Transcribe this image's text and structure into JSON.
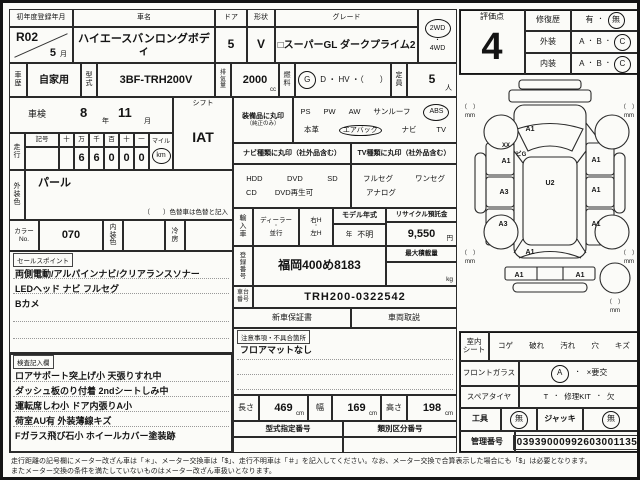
{
  "colors": {
    "paper": "#fbfbf8",
    "ink": "#141414"
  },
  "title_row": {
    "reg_label": "初年度登録年月",
    "reg_value": "R02",
    "reg_month": "5",
    "reg_month_unit": "月",
    "name_label": "車名",
    "name_value": "ハイエースバンロングボディ",
    "door_label": "ドア",
    "door_value": "5",
    "shape_label": "形状",
    "shape_value": "V",
    "grade_label": "グレード",
    "grade_value": "□スーパーGL ダークプライム2",
    "drive_2wd": "2WD",
    "drive_sep": "・",
    "drive_4wd": "4WD"
  },
  "spec_row": {
    "history_label": "車歴",
    "history_value": "自家用",
    "model_code_label": "型式",
    "model_code_value": "3BF-TRH200V",
    "displacement_label": "排気量",
    "displacement_value": "2000",
    "displacement_unit": "cc",
    "fuel_label": "燃料",
    "fuel_selected": "G",
    "fuel_options": "D ・ HV ・（　　）",
    "capacity_label": "定員",
    "capacity_value": "5",
    "capacity_unit": "人"
  },
  "left_panel": {
    "shaken_label": "車検",
    "shaken_year": "8",
    "year_unit": "年",
    "shaken_month": "11",
    "month_unit": "月",
    "shift_label": "シフト",
    "shift_value": "IAT",
    "run_label": "走行",
    "symbol_label": "記号",
    "digit_headers": [
      "十",
      "万",
      "千",
      "百",
      "十",
      "一"
    ],
    "digits": [
      "",
      "6",
      "6",
      "0",
      "0",
      "0"
    ],
    "mile_label": "マイル",
    "km_label": "km",
    "ext_color_label": "外装色",
    "ext_color_value": "パール",
    "color_note": "（　　）色替車は色替と記入",
    "color_no_label": "カラーNo.",
    "color_no_value": "070",
    "int_color_label": "内装色",
    "ac_label": "冷房",
    "sales_tab": "セールスポイント",
    "sales_lines": [
      "両側電動/アルパインナビ/クリアランスソナー",
      "LEDヘッド ナビ フルセグ",
      "Bカメ"
    ],
    "inspect_tab": "検査記入欄",
    "inspect_lines": [
      "ロアサポート突上げ小 天張りすれ中",
      "ダッシュ板のり付着 2ndシートしみ中",
      "運転席しわ小 ドア内張りA小",
      "荷室AU有 外装薄線キズ",
      "Fガラス飛び石小 ホイールカバー塗装跡"
    ]
  },
  "mid_panel": {
    "equip_label": "装備品に丸印",
    "equip_note": "（純正のみ）",
    "equip_row1": [
      "PS",
      "PW",
      "AW",
      "サンルーフ",
      "ABS"
    ],
    "equip_row2": [
      "本革",
      "エアバック",
      "ナビ",
      "TV"
    ],
    "navi_header": "ナビ種類に丸印（社外品含む）",
    "tv_header": "TV種類に丸印（社外品含む）",
    "navi_row1": [
      "HDD",
      "DVD",
      "SD"
    ],
    "navi_row2": [
      "CD",
      "DVD再生可"
    ],
    "tv_row1": [
      "フルセグ",
      "ワンセグ"
    ],
    "tv_row2": [
      "アナログ"
    ],
    "import_label": "輸入車",
    "dealer_option": "ディーラー",
    "parallel_option": "並行",
    "sep": "・",
    "right_h": "右H",
    "left_h": "左H",
    "model_year_label": "モデル年式",
    "model_year_unit": "年",
    "model_year_value": "不明",
    "recycle_label": "リサイクル預託金",
    "recycle_value": "9,550",
    "recycle_unit": "円",
    "plate_label": "登録番号",
    "plate_value": "福岡400め8183",
    "payload_label": "最大積載量",
    "payload_unit": "kg",
    "vin_label": "車台番号",
    "vin_value": "TRH200-0322542",
    "warranty_label": "新車保証書",
    "manual_label": "車両取説",
    "notes_tab": "注意事項・不具合箇所",
    "notes_value": "フロアマットなし",
    "length_label": "長さ",
    "length_value": "469",
    "width_label": "幅",
    "width_value": "169",
    "height_label": "高さ",
    "height_value": "198",
    "cm_unit": "cm",
    "type_cert_label": "型式指定番号",
    "class_no_label": "類別区分番号"
  },
  "right_panel": {
    "eval_label": "評価点",
    "eval_value": "4",
    "repair_label": "修復歴",
    "repair_yes": "有",
    "sep": "・",
    "repair_no": "無",
    "exterior_label": "外装",
    "interior_label": "内装",
    "grade_a": "A",
    "grade_b": "B",
    "grade_c": "C",
    "seat_label_1": "室内",
    "seat_label_2": "シート",
    "seat_items": [
      "コゲ",
      "破れ",
      "汚れ",
      "穴",
      "キズ"
    ],
    "glass_label": "フロントガラス",
    "glass_ok": "A",
    "glass_ng": "×要交",
    "spare_label": "スペアタイヤ",
    "spare_t": "T",
    "spare_kit": "修理KIT",
    "spare_missing": "欠",
    "tools_label": "工具",
    "tools_value": "無",
    "jack_label": "ジャッキ",
    "jack_value": "無",
    "mgmt_label": "管理番号",
    "mgmt_value": "03939000992603001135"
  },
  "diagram": {
    "hood": "A1",
    "a_pillar_left": "XX",
    "windshield": "ビG",
    "roof": "U2",
    "left_front_door": "A1",
    "left_slide_door": "A3",
    "left_quarter": "A3",
    "right_front_door": "A1",
    "right_slide_door": "A1",
    "right_quarter": "A1",
    "rear_gate": "A1",
    "rear_bumper_left": "A1",
    "rear_bumper_right": "A1",
    "bracket": "（　）",
    "mm": "mm"
  },
  "footer": {
    "line1": "走行距離の記号欄にメーター改ざん車は「＊」、メーター交換車は「$」、走行不明車は「＃」を記入してください。なお、メーター交換で合算表示した場合にも「$」は必要となります。",
    "line2": "またメーター交換の条件を満たしていないものはメーター改ざん車扱いとなります。"
  }
}
